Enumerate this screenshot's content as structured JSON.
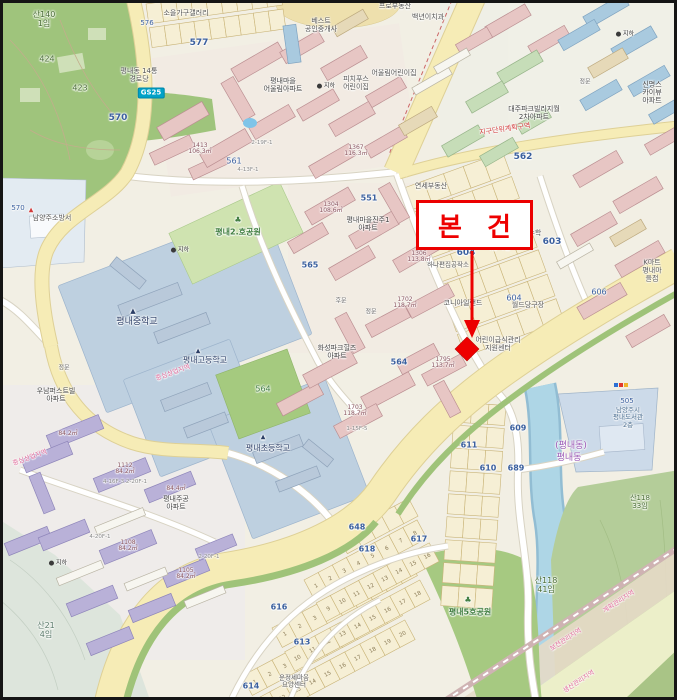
{
  "callout": {
    "label": "본 건"
  },
  "marker": {
    "shape": "diamond",
    "color": "#ee0000"
  },
  "colors": {
    "background": "#f2efe4",
    "road_major": "#f6ecb6",
    "road_minor": "#ffffff",
    "water": "#aed6e6",
    "park_green": "#9fc47c",
    "forest_green": "#b4cd99",
    "school_zone": "#bed0e0",
    "building_pink": "#e7c6c4",
    "building_purple": "#b9b1d8",
    "building_blue": "#a9cadf",
    "building_green": "#c6ddb8",
    "marker_red": "#ee0000",
    "callout_border": "#ec0000",
    "zone_text_pink": "#e06a9a",
    "parcel_text_blue": "#3a5f9e"
  },
  "map": {
    "labels": [
      {
        "t": "산140\n1임",
        "x": 44,
        "y": 20,
        "s": 8,
        "c": "#4a6d35",
        "n": "parcel-san140-1"
      },
      {
        "t": "424",
        "x": 47,
        "y": 60,
        "s": 8,
        "c": "#4a6d35",
        "n": "parcel-424"
      },
      {
        "t": "423",
        "x": 80,
        "y": 89,
        "s": 8,
        "c": "#4a6d35",
        "n": "parcel-423"
      },
      {
        "t": "570",
        "x": 118,
        "y": 118,
        "s": 9,
        "c": "#3a5f9e",
        "b": 1,
        "n": "parcel-570"
      },
      {
        "t": "576",
        "x": 147,
        "y": 24,
        "s": 7,
        "c": "#3a5f9e",
        "n": "parcel-576"
      },
      {
        "t": "577",
        "x": 199,
        "y": 43,
        "s": 9,
        "c": "#3a5f9e",
        "b": 1,
        "n": "parcel-577"
      },
      {
        "t": "소을가구갤러리",
        "x": 186,
        "y": 14,
        "s": 7,
        "n": "poi-soeul-furniture-gallery"
      },
      {
        "t": "평내동 14통\n경로당",
        "x": 139,
        "y": 76,
        "s": 7,
        "n": "poi-senior-center"
      },
      {
        "t": "GS25",
        "x": 151,
        "y": 93,
        "s": 7,
        "c": "#ffffff",
        "cls": "badge",
        "n": "poi-gs25-store"
      },
      {
        "t": "베스트\n공인중개사",
        "x": 321,
        "y": 26,
        "s": 7,
        "n": "poi-best-realty"
      },
      {
        "t": "프로부동산",
        "x": 395,
        "y": 7,
        "s": 7,
        "n": "poi-pro-realty"
      },
      {
        "t": "백년이치과",
        "x": 428,
        "y": 18,
        "s": 7,
        "n": "poi-dental-clinic"
      },
      {
        "t": "연세부동산",
        "x": 431,
        "y": 187,
        "s": 7,
        "n": "poi-yonsei-realty"
      },
      {
        "t": "어울림어린이집",
        "x": 394,
        "y": 74,
        "s": 7,
        "n": "poi-oullim-daycare"
      },
      {
        "t": "피치푸스\n어린이집",
        "x": 356,
        "y": 84,
        "s": 7,
        "n": "poi-daycare"
      },
      {
        "t": "평내마을\n어울림아파트",
        "x": 283,
        "y": 86,
        "s": 7,
        "c": "#444444",
        "n": "apt-oullim"
      },
      {
        "t": "대주파크빌리지월\n2차아파트",
        "x": 534,
        "y": 114,
        "s": 7,
        "c": "#444444",
        "n": "apt-daeju-parkvillage"
      },
      {
        "t": "신명스카이뷰\n아파트",
        "x": 652,
        "y": 93,
        "s": 7,
        "c": "#444444",
        "n": "apt-shinmyung-skyview"
      },
      {
        "t": "정문",
        "x": 585,
        "y": 83,
        "s": 6,
        "c": "#666666",
        "n": "gate-main-1"
      },
      {
        "t": "정문",
        "x": 64,
        "y": 369,
        "s": 6,
        "c": "#666666",
        "n": "gate-main-2"
      },
      {
        "t": "후문",
        "x": 341,
        "y": 302,
        "s": 6,
        "c": "#666666",
        "n": "gate-rear"
      },
      {
        "t": "정문",
        "x": 371,
        "y": 313,
        "s": 6,
        "c": "#666666",
        "n": "gate-main-3"
      },
      {
        "t": "지하",
        "x": 326,
        "y": 87,
        "s": 6,
        "c": "#333333",
        "cls": "sub",
        "n": "underground-parking-marker"
      },
      {
        "t": "지하",
        "x": 180,
        "y": 251,
        "s": 6,
        "c": "#333333",
        "cls": "sub",
        "n": "underground-parking-marker"
      },
      {
        "t": "지하",
        "x": 625,
        "y": 35,
        "s": 6,
        "c": "#333333",
        "cls": "sub",
        "n": "underground-parking-marker"
      },
      {
        "t": "지하",
        "x": 58,
        "y": 564,
        "s": 6,
        "c": "#333333",
        "cls": "sub",
        "n": "underground-parking-marker"
      },
      {
        "t": "562",
        "x": 523,
        "y": 157,
        "s": 9,
        "c": "#3a5f9e",
        "b": 1,
        "n": "parcel-562"
      },
      {
        "t": "561",
        "x": 234,
        "y": 162,
        "s": 8,
        "c": "#3a5f9e",
        "n": "parcel-561"
      },
      {
        "t": "지구단위계획구역",
        "x": 505,
        "y": 130,
        "s": 7,
        "c": "#d23c3c",
        "r": -8,
        "n": "zone-district-unit-plan"
      },
      {
        "t": "551",
        "x": 369,
        "y": 199,
        "s": 8,
        "c": "#3a5f9e",
        "b": 1,
        "n": "parcel-551"
      },
      {
        "t": "♣",
        "x": 238,
        "y": 221,
        "s": 8,
        "c": "#3f7d3f",
        "n": "tree-icon"
      },
      {
        "t": "평내2.호공원",
        "x": 238,
        "y": 233,
        "s": 8,
        "c": "#3f7d3f",
        "b": 1,
        "n": "park-pyeongnae-2"
      },
      {
        "t": "평내마을진주1\n아파트",
        "x": 368,
        "y": 225,
        "s": 7,
        "c": "#444444",
        "n": "apt-jinju-1"
      },
      {
        "t": "약올리는수학",
        "x": 522,
        "y": 234,
        "s": 7,
        "n": "poi-math-academy"
      },
      {
        "t": "603",
        "x": 552,
        "y": 242,
        "s": 9,
        "c": "#3a5f9e",
        "b": 1,
        "n": "parcel-603"
      },
      {
        "t": "미술학원",
        "x": 498,
        "y": 248,
        "s": 7,
        "n": "poi-art-academy"
      },
      {
        "t": "604",
        "x": 466,
        "y": 253,
        "s": 9,
        "c": "#3a5f9e",
        "b": 1,
        "n": "parcel-604"
      },
      {
        "t": "하나편집공작소",
        "x": 448,
        "y": 265,
        "s": 6.5,
        "n": "poi-hana-workshop"
      },
      {
        "t": "565",
        "x": 310,
        "y": 266,
        "s": 8,
        "c": "#3a5f9e",
        "b": 1,
        "n": "parcel-565"
      },
      {
        "t": "코니아일랜드",
        "x": 463,
        "y": 304,
        "s": 7,
        "n": "poi-coney-island"
      },
      {
        "t": "월드당구장",
        "x": 528,
        "y": 306,
        "s": 7,
        "n": "poi-world-billiards"
      },
      {
        "t": "604",
        "x": 514,
        "y": 299,
        "s": 8,
        "c": "#3a5f9e",
        "n": "parcel-604b"
      },
      {
        "t": "K마트\n평내마을점",
        "x": 652,
        "y": 271,
        "s": 7,
        "n": "poi-kmart"
      },
      {
        "t": "606",
        "x": 599,
        "y": 293,
        "s": 8,
        "c": "#3a5f9e",
        "n": "parcel-606"
      },
      {
        "t": "570",
        "x": 18,
        "y": 209,
        "s": 7,
        "c": "#3a5f9e",
        "n": "parcel-570b"
      },
      {
        "t": "▲",
        "x": 31,
        "y": 211,
        "s": 6,
        "c": "#d23c3c",
        "n": "fire-station-icon"
      },
      {
        "t": "남양주소방서",
        "x": 52,
        "y": 219,
        "s": 7,
        "n": "poi-fire-station"
      },
      {
        "t": "▲",
        "x": 133,
        "y": 312,
        "s": 7,
        "c": "#2b3e66",
        "n": "school-icon"
      },
      {
        "t": "평내중학교",
        "x": 137,
        "y": 322,
        "s": 9,
        "c": "#2b3e66",
        "n": "school-pyeongnae-middle"
      },
      {
        "t": "어린이급식관리\n지원센터",
        "x": 498,
        "y": 345,
        "s": 7,
        "n": "poi-children-food-center"
      },
      {
        "t": "화성파크힐즈\n아파트",
        "x": 337,
        "y": 353,
        "s": 7,
        "c": "#444444",
        "n": "apt-hwaseong-parkhills"
      },
      {
        "t": "564",
        "x": 399,
        "y": 363,
        "s": 8,
        "c": "#3a5f9e",
        "b": 1,
        "n": "parcel-564-road"
      },
      {
        "t": "564",
        "x": 263,
        "y": 390,
        "s": 8,
        "c": "#3f7d3f",
        "n": "parcel-564-park"
      },
      {
        "t": "▲",
        "x": 198,
        "y": 352,
        "s": 6,
        "c": "#2b3e66",
        "n": "school-icon"
      },
      {
        "t": "평내고등학교",
        "x": 205,
        "y": 361,
        "s": 8,
        "c": "#2b3e66",
        "n": "school-pyeongnae-high"
      },
      {
        "t": "중심상업지역",
        "x": 30,
        "y": 458,
        "s": 6.5,
        "c": "#e06a9a",
        "r": -20,
        "n": "zone-central-commercial"
      },
      {
        "t": "중심상업지역",
        "x": 173,
        "y": 373,
        "s": 6.5,
        "c": "#e06a9a",
        "r": -20,
        "n": "zone-central-commercial"
      },
      {
        "t": "우남퍼스트빌\n아파트",
        "x": 56,
        "y": 396,
        "s": 7,
        "c": "#444444",
        "n": "apt-woonam-firstville"
      },
      {
        "t": "▲",
        "x": 263,
        "y": 438,
        "s": 6,
        "c": "#2b3e66",
        "n": "school-icon"
      },
      {
        "t": "평내초등학교",
        "x": 268,
        "y": 449,
        "s": 8,
        "c": "#2b3e66",
        "n": "school-pyeongnae-elementary"
      },
      {
        "t": "1413\n106.3㎡",
        "x": 200,
        "y": 149,
        "s": 6,
        "c": "#8a5560",
        "cls": "bl",
        "n": "building-label"
      },
      {
        "t": "1367\n116.3㎡",
        "x": 356,
        "y": 151,
        "s": 6,
        "c": "#8a5560",
        "cls": "bl",
        "n": "building-label"
      },
      {
        "t": "1304\n108.6㎡",
        "x": 331,
        "y": 208,
        "s": 6,
        "c": "#8a5560",
        "cls": "bl",
        "n": "building-label"
      },
      {
        "t": "1306\n113.8㎡",
        "x": 419,
        "y": 257,
        "s": 6,
        "c": "#8a5560",
        "cls": "bl",
        "n": "building-label"
      },
      {
        "t": "1702\n118.7㎡",
        "x": 405,
        "y": 303,
        "s": 6,
        "c": "#8a5560",
        "cls": "bl",
        "n": "building-label"
      },
      {
        "t": "1703\n118.7㎡",
        "x": 355,
        "y": 411,
        "s": 6,
        "c": "#8a5560",
        "cls": "bl",
        "n": "building-label"
      },
      {
        "t": "1795\n113.7㎡",
        "x": 443,
        "y": 363,
        "s": 6,
        "c": "#8a5560",
        "cls": "bl",
        "n": "building-label"
      },
      {
        "t": "1112\n84.2㎡",
        "x": 125,
        "y": 469,
        "s": 6,
        "c": "#8a5560",
        "cls": "bl",
        "n": "building-label"
      },
      {
        "t": "1108\n84.2㎡",
        "x": 128,
        "y": 546,
        "s": 6,
        "c": "#8a5560",
        "cls": "bl",
        "n": "building-label"
      },
      {
        "t": "1105\n84.2㎡",
        "x": 186,
        "y": 574,
        "s": 6,
        "c": "#8a5560",
        "cls": "bl",
        "n": "building-label"
      },
      {
        "t": "84.2㎡",
        "x": 68,
        "y": 434,
        "s": 6,
        "c": "#8a5560",
        "cls": "bl",
        "n": "building-label"
      },
      {
        "t": "84.4㎡",
        "x": 176,
        "y": 489,
        "s": 6,
        "c": "#8a5560",
        "cls": "bl",
        "n": "building-label"
      },
      {
        "t": "4-16F-3  2-20F-1",
        "x": 125,
        "y": 482,
        "s": 5.5,
        "c": "#8a8a8a",
        "n": "floor-label"
      },
      {
        "t": "4-20F-1",
        "x": 100,
        "y": 537,
        "s": 5.5,
        "c": "#8a8a8a",
        "n": "floor-label"
      },
      {
        "t": "2-20F-1",
        "x": 209,
        "y": 557,
        "s": 5.5,
        "c": "#8a8a8a",
        "n": "floor-label"
      },
      {
        "t": "1-15F-5",
        "x": 357,
        "y": 429,
        "s": 5.5,
        "c": "#8a8a8a",
        "n": "floor-label"
      },
      {
        "t": "2-19F-1",
        "x": 262,
        "y": 143,
        "s": 5.5,
        "c": "#8a8a8a",
        "n": "floor-label"
      },
      {
        "t": "4-13F-1",
        "x": 248,
        "y": 170,
        "s": 5.5,
        "c": "#8a8a8a",
        "n": "floor-label"
      },
      {
        "t": "(평내동)",
        "x": 571,
        "y": 446,
        "s": 9,
        "c": "#9b59b6",
        "n": "district-pyeongnae-dong"
      },
      {
        "t": "평내동",
        "x": 569,
        "y": 458,
        "s": 9,
        "c": "#9b59b6",
        "n": "district-pyeongnae-dong"
      },
      {
        "t": "505",
        "x": 627,
        "y": 402,
        "s": 7,
        "c": "#3a5f9e",
        "n": "parcel-505"
      },
      {
        "t": "남양주시\n평내도서관\n2층",
        "x": 628,
        "y": 418,
        "s": 6.5,
        "c": "#4a6d8f",
        "n": "poi-pyeongnae-library"
      },
      {
        "t": "산118\n33임",
        "x": 640,
        "y": 503,
        "s": 7,
        "c": "#4a6d35",
        "n": "parcel-san118-33"
      },
      {
        "t": "산118\n41임",
        "x": 546,
        "y": 586,
        "s": 8,
        "c": "#4a6d35",
        "n": "parcel-san118-41"
      },
      {
        "t": "계획관리지역",
        "x": 619,
        "y": 602,
        "s": 6.5,
        "c": "#e06a9a",
        "r": -33,
        "n": "zone-plan-management"
      },
      {
        "t": "보전관리지역",
        "x": 566,
        "y": 640,
        "s": 6.5,
        "c": "#e06a9a",
        "r": -33,
        "n": "zone-preservation-management"
      },
      {
        "t": "생산관리지역",
        "x": 579,
        "y": 682,
        "s": 6.5,
        "c": "#e06a9a",
        "r": -33,
        "n": "zone-production-management"
      },
      {
        "t": "산21\n4임",
        "x": 46,
        "y": 631,
        "s": 8,
        "c": "#5a7a6a",
        "n": "parcel-san21-4"
      },
      {
        "t": "평내주공\n아파트",
        "x": 176,
        "y": 504,
        "s": 7,
        "c": "#444444",
        "n": "apt-jugong"
      },
      {
        "t": "♣",
        "x": 468,
        "y": 601,
        "s": 8,
        "c": "#3f7d3f",
        "n": "tree-icon"
      },
      {
        "t": "평내5호공원",
        "x": 470,
        "y": 613,
        "s": 8,
        "c": "#3f7d3f",
        "b": 1,
        "n": "park-pyeongnae-5"
      },
      {
        "t": "운정세마음\n요양센터",
        "x": 294,
        "y": 682,
        "s": 6.5,
        "n": "poi-care-center"
      },
      {
        "t": "648",
        "x": 357,
        "y": 528,
        "s": 8,
        "c": "#3a5f9e",
        "b": 1,
        "n": "parcel-648"
      },
      {
        "t": "618",
        "x": 367,
        "y": 550,
        "s": 8,
        "c": "#3a5f9e",
        "b": 1,
        "n": "parcel-618"
      },
      {
        "t": "617",
        "x": 419,
        "y": 540,
        "s": 8,
        "c": "#3a5f9e",
        "b": 1,
        "n": "parcel-617"
      },
      {
        "t": "616",
        "x": 279,
        "y": 608,
        "s": 8,
        "c": "#3a5f9e",
        "b": 1,
        "n": "parcel-616"
      },
      {
        "t": "613",
        "x": 302,
        "y": 643,
        "s": 8,
        "c": "#3a5f9e",
        "b": 1,
        "n": "parcel-613"
      },
      {
        "t": "614",
        "x": 251,
        "y": 687,
        "s": 8,
        "c": "#3a5f9e",
        "b": 1,
        "n": "parcel-614"
      },
      {
        "t": "611",
        "x": 469,
        "y": 446,
        "s": 8,
        "c": "#3a5f9e",
        "b": 1,
        "n": "parcel-611"
      },
      {
        "t": "609",
        "x": 518,
        "y": 429,
        "s": 8,
        "c": "#3a5f9e",
        "b": 1,
        "n": "parcel-609"
      },
      {
        "t": "610",
        "x": 488,
        "y": 469,
        "s": 8,
        "c": "#3a5f9e",
        "b": 1,
        "n": "parcel-610"
      },
      {
        "t": "689",
        "x": 516,
        "y": 469,
        "s": 8,
        "c": "#3a5f9e",
        "b": 1,
        "n": "parcel-689"
      }
    ]
  }
}
